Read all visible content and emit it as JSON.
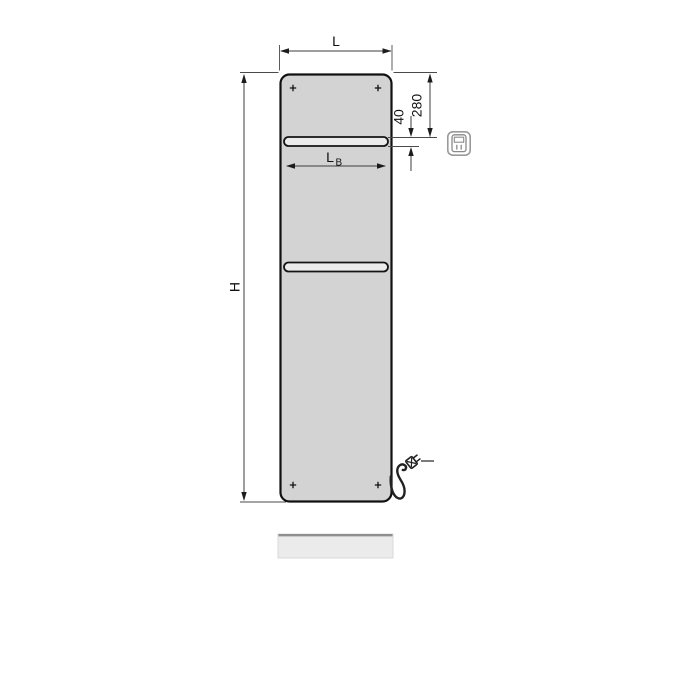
{
  "diagram": {
    "type": "technical-dimension-drawing",
    "subject": "electric flat panel radiator, front view with towel bars, power cord and plug",
    "labels": {
      "width": "L",
      "height": "H",
      "bar_width_main": "L",
      "bar_width_sub": "B",
      "top_to_bar": "280",
      "bar_opening": "40"
    },
    "icons": {
      "control": "electric-control-unit-icon",
      "plug": "power-plug-icon",
      "screw": "screw-cross-mark"
    },
    "colors": {
      "background": "#ffffff",
      "panel_fill": "#d3d3d3",
      "panel_stroke": "#111111",
      "bar_fill": "#ebebeb",
      "dim_line": "#3c3c3c",
      "label_text": "#111111",
      "icon_gray": "#9a9a9a",
      "shadow_fill": "#ebebeb",
      "shadow_edge": "#8f8f8f",
      "cord": "#222222"
    }
  }
}
